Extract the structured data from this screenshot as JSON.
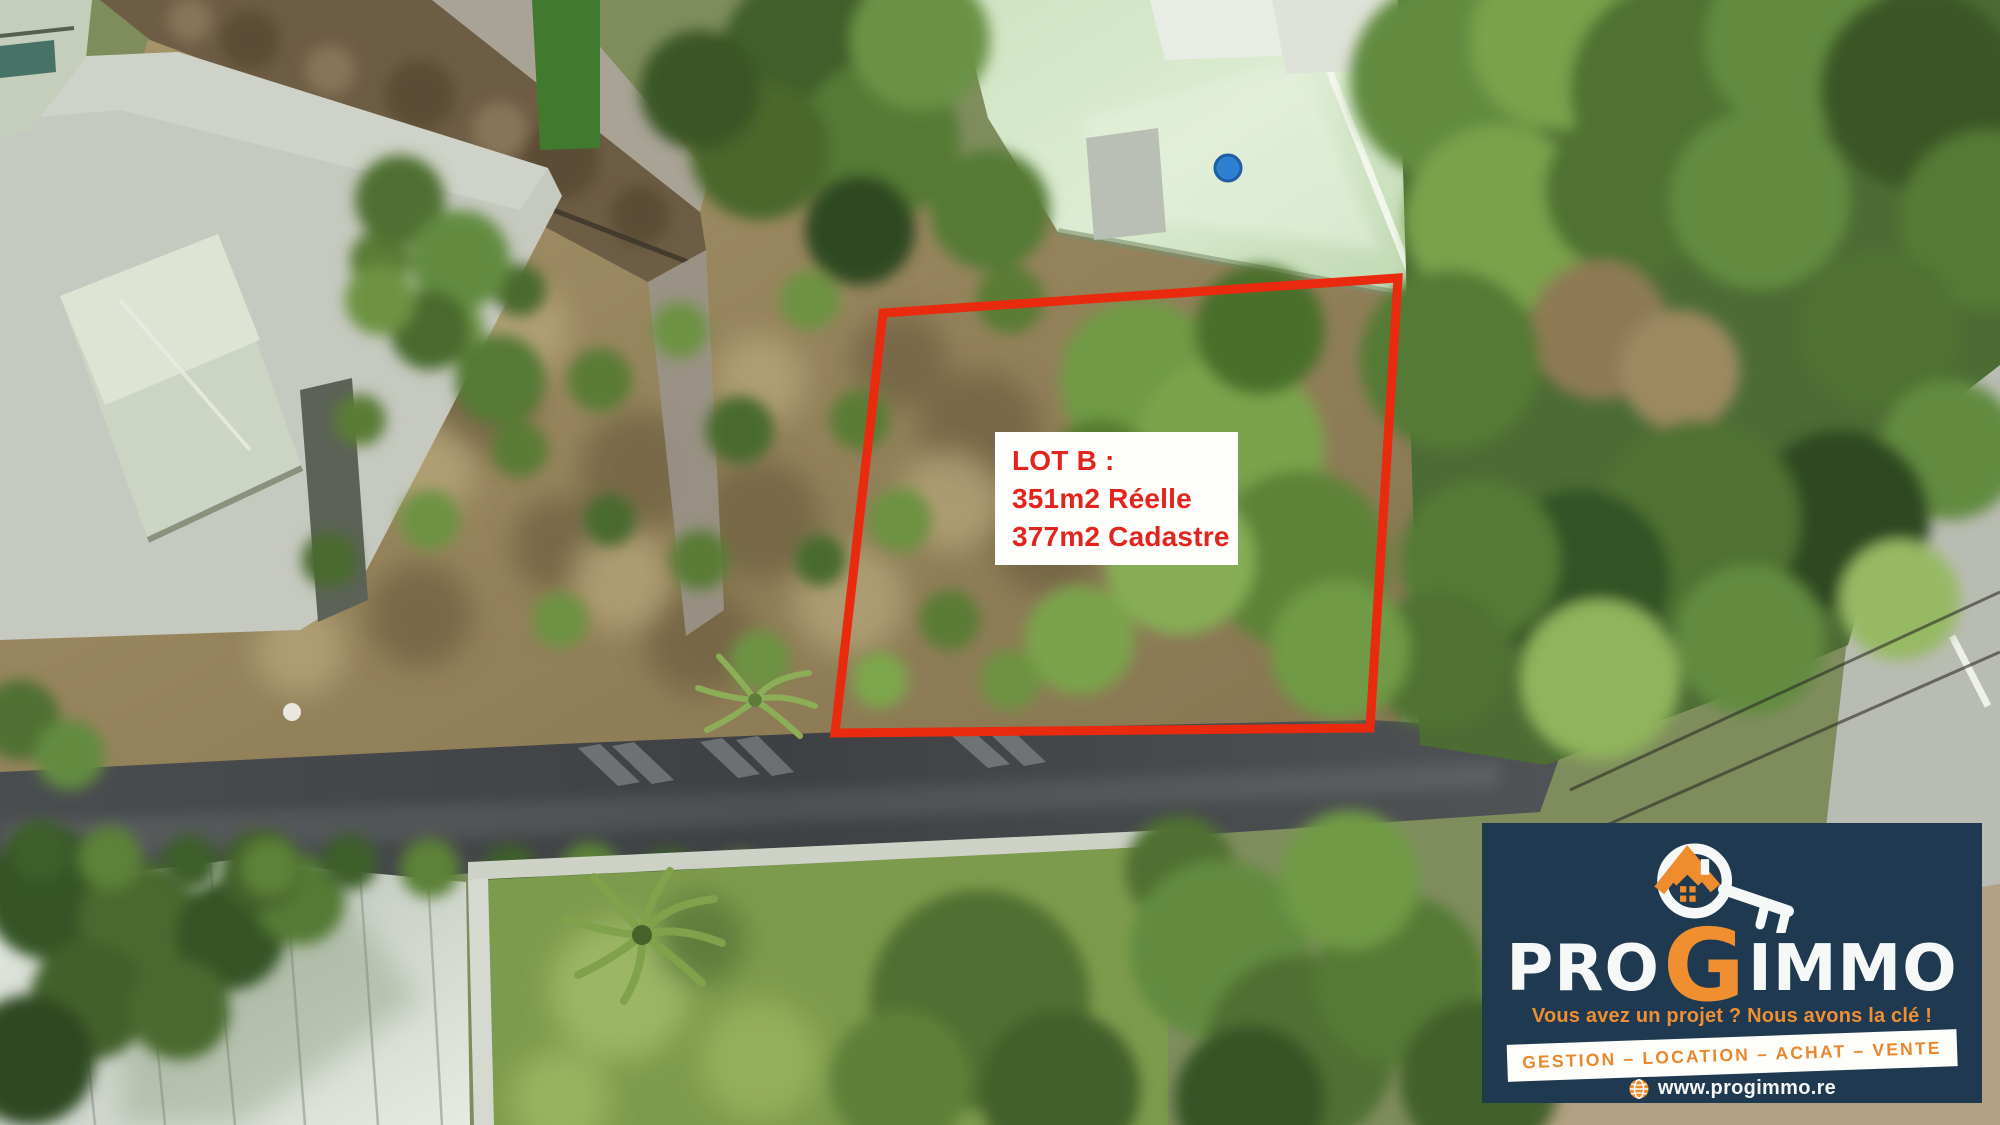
{
  "annotation": {
    "lot_label": {
      "line1": "LOT B :",
      "line2": "351m2 Réelle",
      "line3": "377m2 Cadastre",
      "text_color": "#e3241c",
      "box_background": "#ffffff"
    },
    "boundary_color": "#ea2a0e"
  },
  "branding": {
    "name_part1": "PRO",
    "name_part2": "G",
    "name_part3": "IMMO",
    "tagline": "Vous avez un projet ? Nous avons la clé !",
    "services_banner": "GESTION – LOCATION – ACHAT – VENTE",
    "website": "www.progimmo.re",
    "panel_background": "#1e3950",
    "accent_orange": "#ee8c2e",
    "icons": {
      "logo": "house-magnifier-key-icon",
      "website": "globe-icon"
    }
  }
}
